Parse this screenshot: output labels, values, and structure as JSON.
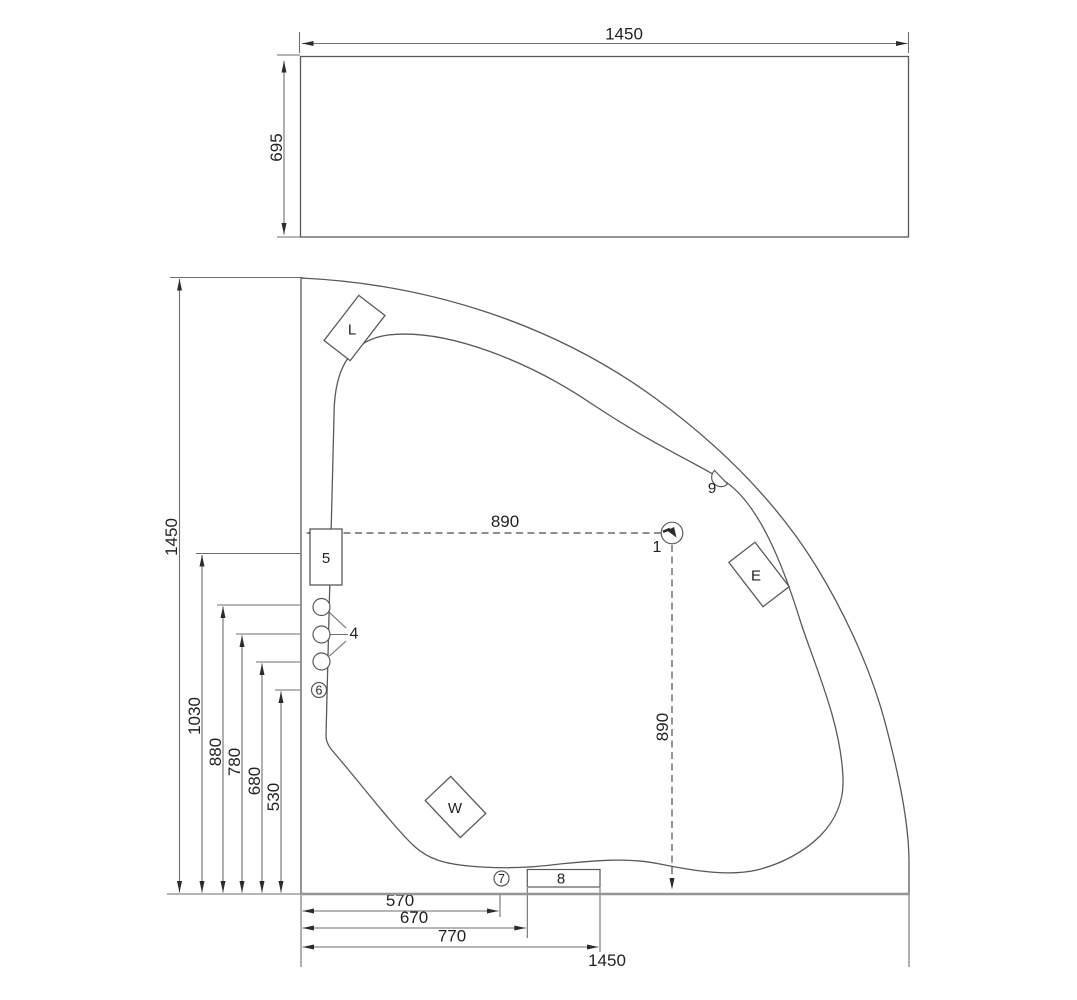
{
  "side_view": {
    "width_dim": "1450",
    "height_dim": "695"
  },
  "plan_view": {
    "vertical_dims": {
      "total": "1450",
      "d1030": "1030",
      "d880": "880",
      "d780": "780",
      "d680": "680",
      "d530": "530"
    },
    "horizontal_dims": {
      "d570": "570",
      "d670": "670",
      "d770": "770",
      "total": "1450"
    },
    "drain_dims": {
      "horizontal": "890",
      "vertical": "890"
    },
    "labels": {
      "n1": "1",
      "n4": "4",
      "n5": "5",
      "n6": "6",
      "n7": "7",
      "n8": "8",
      "n9": "9",
      "L": "L",
      "E": "E",
      "W": "W"
    }
  },
  "colors": {
    "line": "#58595b",
    "dim_line": "#6d6e71",
    "wall_line": "#939598",
    "text": "#231f20",
    "background": "#ffffff"
  }
}
